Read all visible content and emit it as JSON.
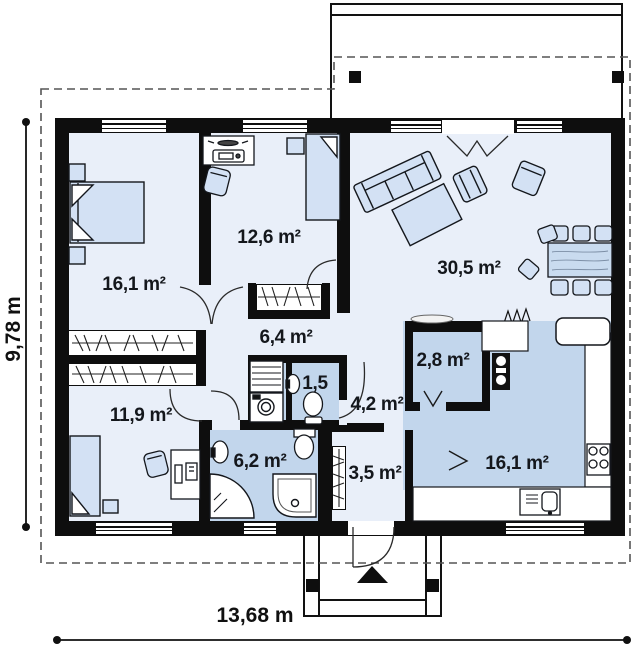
{
  "plan": {
    "title": "single-storey house floor plan",
    "rooms": [
      {
        "name": "bedroom-1",
        "area": "16,1 m²"
      },
      {
        "name": "bedroom-2",
        "area": "12,6 m²"
      },
      {
        "name": "living-room",
        "area": "30,5 m²"
      },
      {
        "name": "corridor",
        "area": "6,4 m²"
      },
      {
        "name": "wc",
        "area": "1,5"
      },
      {
        "name": "hall",
        "area": "4,2 m²"
      },
      {
        "name": "bedroom-3",
        "area": "11,9 m²"
      },
      {
        "name": "bathroom",
        "area": "6,2 m²"
      },
      {
        "name": "vestibule",
        "area": "3,5 m²"
      },
      {
        "name": "pantry",
        "area": "2,8 m²"
      },
      {
        "name": "kitchen",
        "area": "16,1 m²"
      }
    ],
    "dimensions": {
      "width_label": "13,68 m",
      "height_label": "9,78 m"
    },
    "colors": {
      "wall": "#0e0e0e",
      "floor_light": "#e9eff9",
      "floor_wet": "#c2d6ec",
      "furniture": "#d3e1f4",
      "roof_dashed": "#555555"
    }
  }
}
